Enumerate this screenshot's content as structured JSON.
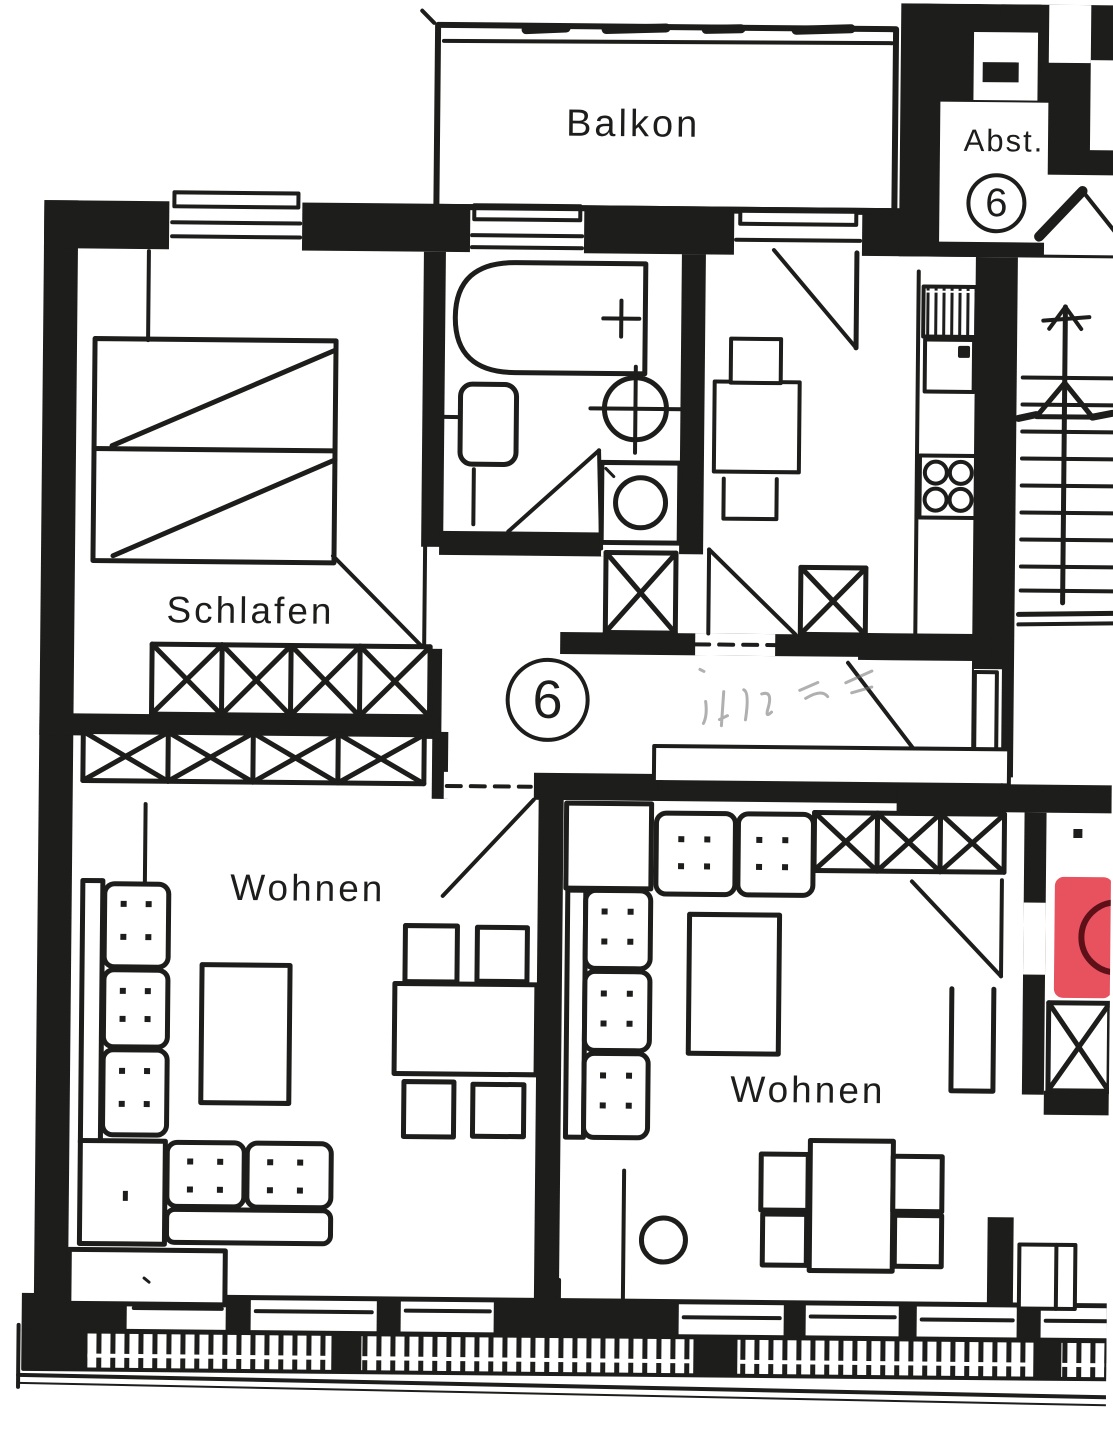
{
  "document": {
    "kind": "scanned hand-drawn apartment floor plan (Grundriss)",
    "unit": "6"
  },
  "rooms": {
    "balkon": {
      "label": "Balkon"
    },
    "abstellraum": {
      "label": "Abst.",
      "badge": "6"
    },
    "schlafen": {
      "label": "Schlafen"
    },
    "flur": {
      "badge": "6",
      "note": "illegible pencil scribble"
    },
    "wohnen_links": {
      "label": "Wohnen"
    },
    "wohnen_rechts": {
      "label": "Wohnen"
    }
  },
  "annotations": {
    "red_highlight": {
      "description": "red marker highlighting fixture at right edge",
      "fill": "#e8515e",
      "ring": "#5d1018"
    }
  },
  "palette": {
    "ink": "#1d1d1b",
    "paper": "#ffffff"
  }
}
